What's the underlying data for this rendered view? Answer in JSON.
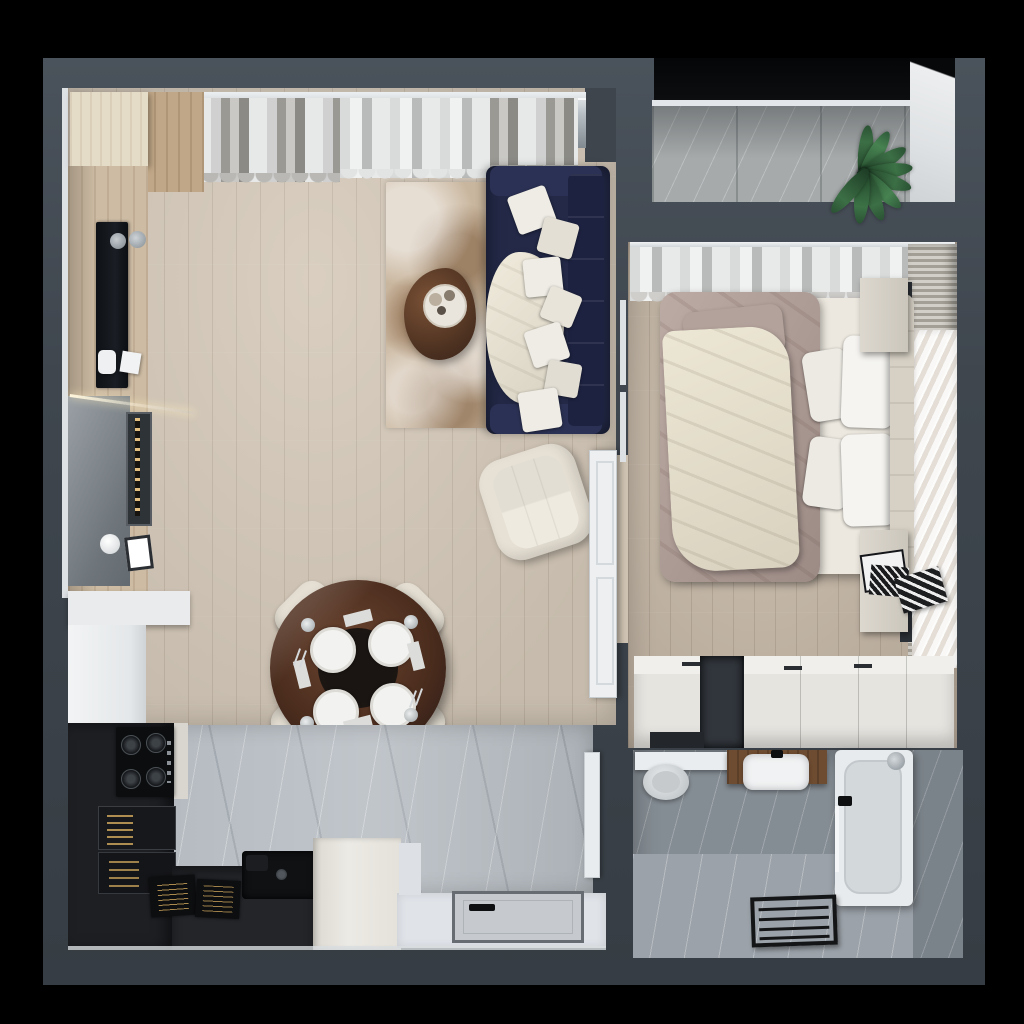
{
  "meta": {
    "scene_label": "Top-down 3D render of a one-bedroom apartment floor plan",
    "view": "top-down interior visualization",
    "text_on_screen": "none"
  },
  "palette": {
    "background": "#000000",
    "wall": "#3e454d",
    "floor_wood": "#d5c9b9",
    "floor_wood_dark": "#c8baa9",
    "floor_marble": "#b6bcc2",
    "hall_floor": "#e0e4e9",
    "kitchen_dark": "#1d1f23",
    "counter_dark": "#232529",
    "cabinet_white": "#eceae5",
    "sofa_navy": "#232947",
    "pillow_white": "#eeece4",
    "rug_beige": "#c9b69e",
    "table_brown": "#4a2c1d",
    "chair_cream": "#e6e0d4",
    "bed_taupe": "#b3a29b",
    "blanket_cream": "#e9e3d2",
    "headboard_cream": "#d7d1c5",
    "wardrobe_white": "#e6e4df",
    "bath_tile": "#858d94",
    "tub_white": "#e8ebed",
    "vanity_wood": "#6e4c31",
    "balcony_stone": "#a6aaab",
    "plant_green": "#3c6f45",
    "door_white": "#edeff1",
    "gold_accent": "#deb262"
  },
  "rooms": {
    "living_room": {
      "label": "Living room",
      "furniture": [
        "window curtains",
        "navy sofa",
        "decorative pillows",
        "throw blanket",
        "area rug",
        "organic coffee table",
        "serving tray with cups",
        "swivel armchair",
        "wood tv wall panel",
        "wall tv",
        "wall speakers",
        "led accent strip",
        "decor shelf",
        "open white door"
      ],
      "sofa_pillow_count": 7
    },
    "dining_area": {
      "label": "Dining area",
      "furniture": [
        "round glass dining table",
        "cream shell chairs",
        "place settings with plates, glasses, napkins and cutlery"
      ],
      "chair_count": 4,
      "place_setting_count": 4
    },
    "kitchen": {
      "label": "Kitchen",
      "furniture": [
        "white countertop column",
        "refrigerator cabinet",
        "black tall unit",
        "gas hob",
        "illuminated appliance shelves",
        "black undermount sink",
        "dark worktop",
        "cook books",
        "white base cabinet"
      ]
    },
    "bedroom": {
      "label": "Bedroom",
      "furniture": [
        "blackout curtains",
        "double bed",
        "taupe duvet",
        "cream bedspread",
        "white pillows",
        "upholstered headboard",
        "nightstands",
        "magazines",
        "sliding wardrobe",
        "feather wall mural",
        "slatted wall panels"
      ],
      "bed_pillow_count": 4
    },
    "bathroom": {
      "label": "Bathroom",
      "furniture": [
        "toilet",
        "wall shelf",
        "wooden vanity with white basin",
        "bathtub",
        "shower head",
        "glass screen",
        "black towel ladder",
        "white door"
      ]
    },
    "balcony": {
      "label": "Balcony",
      "furniture": [
        "panoramic window",
        "stone tile floor",
        "potted plant",
        "white side wall"
      ]
    },
    "hallway": {
      "label": "Entrance hall",
      "furniture": [
        "entrance door with black handle",
        "light floor"
      ]
    }
  }
}
